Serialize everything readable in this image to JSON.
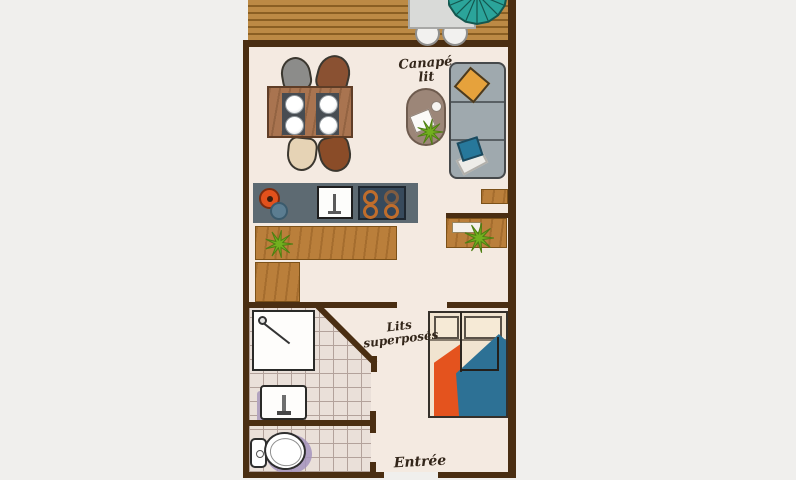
{
  "title": "Studio apartment floor plan",
  "labels": {
    "sofa_bed": [
      "Canapé",
      "lit"
    ],
    "bunk_beds": [
      "Lits",
      "superposés"
    ],
    "entrance": "Entrée"
  },
  "icons": [
    "umbrella-icon",
    "plant-icon",
    "shower-head-icon",
    "toilet-icon",
    "sink-icon",
    "cooktop-icon",
    "plate-icon"
  ],
  "colors": {
    "background": "#f0efed",
    "floor": "#f4eae1",
    "wall": "#4a2e12",
    "deck_wood": "#b98440",
    "furniture_wood": "#ba7f3b",
    "kitchen_counter": "#5d6a72",
    "sofa_gray": "#9fa9ae",
    "umbrella_teal": "#2ba49a",
    "blanket_orange": "#e4531e",
    "blanket_blue": "#2d7195",
    "pillow_yellow": "#e6a23c",
    "pillow_teal": "#27789b",
    "plant_green": "#72b01f",
    "tile_line": "#b3a29b",
    "toilet_shadow": "#a593bd"
  }
}
